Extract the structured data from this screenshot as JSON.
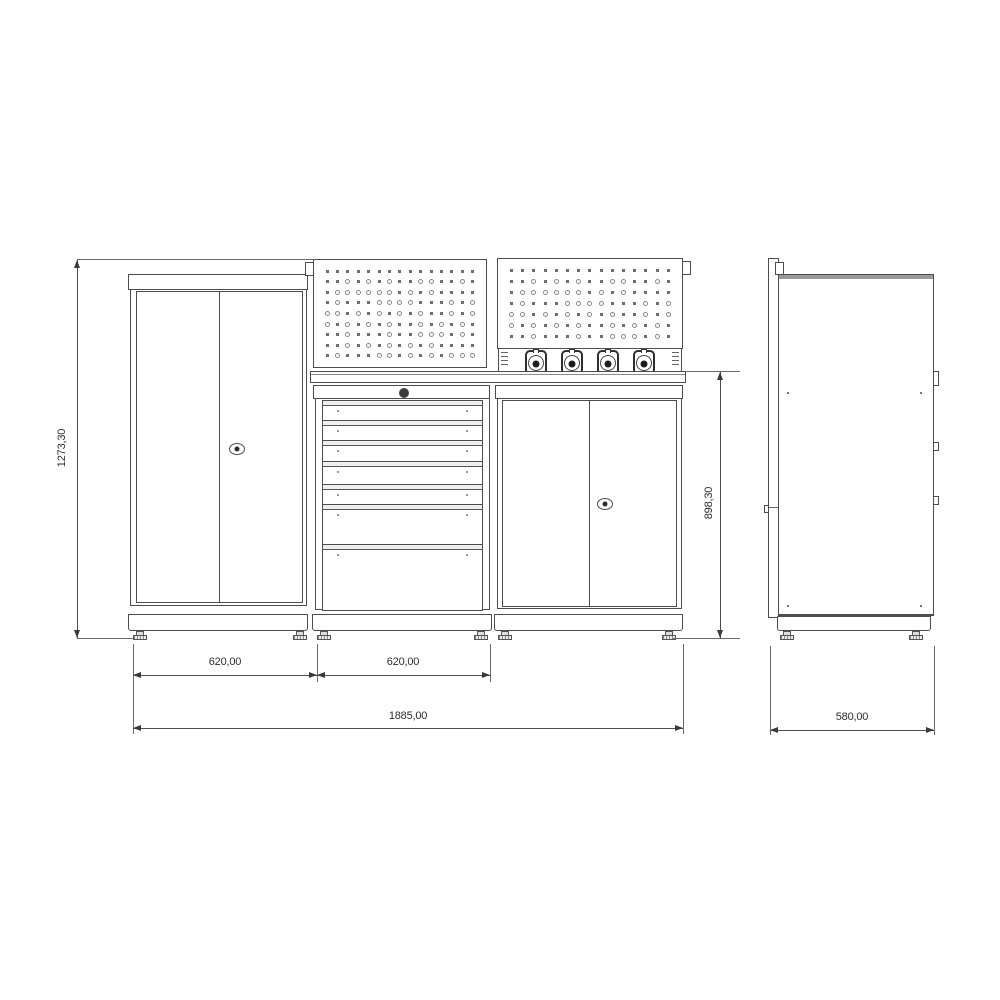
{
  "drawing": {
    "kind": "technical-drawing",
    "subject": "modular workshop cabinet combination, front and side orthographic views",
    "dims": {
      "overall_height": "1273,30",
      "bench_height": "898,30",
      "module1_width": "620,00",
      "module2_width": "620,00",
      "overall_width": "1885,00",
      "depth": "580,00"
    },
    "front": {
      "left_cabinet": {
        "doors": 2,
        "lock": true
      },
      "drawer_unit": {
        "lock": true,
        "drawer_count": 7,
        "drawers": [
          19,
          19,
          20,
          22,
          19,
          39,
          65
        ]
      },
      "right_cabinet": {
        "doors": 2,
        "lock": true
      },
      "pegboards": [
        {
          "rows": 9,
          "cols": 15
        },
        {
          "rows": 7,
          "cols": 15
        }
      ],
      "power_strip": {
        "socket_count": 4
      },
      "feet_per_module": 2
    },
    "side": {
      "corner_screws": 4,
      "wall_panel": true
    },
    "colors": {
      "line": "#4d4d4d",
      "line_light": "#8a8a8a",
      "text": "#2e2e2e",
      "background": "#ffffff",
      "socket_core": "#1d1d1d"
    }
  }
}
